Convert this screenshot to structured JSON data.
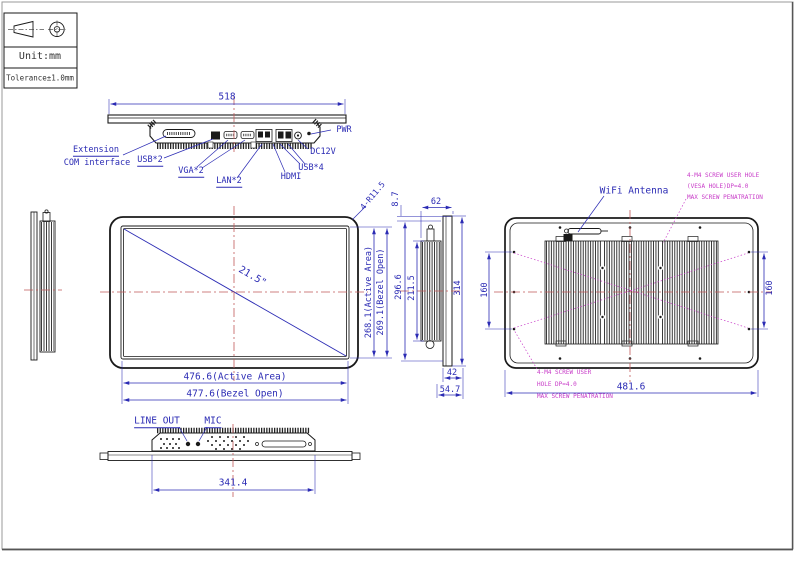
{
  "sheet": {
    "unit": "Unit:mm",
    "tolerance": "Tolerance±1.0mm",
    "projection_symbol": "first-angle-projection-icon"
  },
  "colors": {
    "outline": "#1a1a1a",
    "dimension": "#2b2bb4",
    "centerline": "#c05a5a",
    "note": "#c83cc8"
  },
  "top_view": {
    "dim_width": "518",
    "label_extension_1": "Extension",
    "label_extension_2": "COM interface",
    "label_usb2": "USB*2",
    "label_vga2": "VGA*2",
    "label_lan2": "LAN*2",
    "label_hdmi": "HDMI",
    "label_usb4": "USB*4",
    "label_dc12v": "DC12V",
    "label_pwr": "PWR"
  },
  "front_view": {
    "diagonal_size": "21.5\"",
    "corner_radius": "4-R11.5",
    "dim_height_active": "268.1(Active Area)",
    "dim_height_bezel": "269.1(Bezel Open)",
    "dim_width_active": "476.6(Active Area)",
    "dim_width_bezel": "477.6(Bezel Open)"
  },
  "side_view": {
    "dim_bezel_lip": "8.7",
    "dim_depth": "62",
    "dim_body_height": "296.6",
    "dim_heatsink_height": "211.5",
    "dim_total_height": "314",
    "dim_rear_offset": "42",
    "dim_total_depth": "54.7"
  },
  "rear_view": {
    "label_antenna": "WiFi Antenna",
    "note_top_1": "4-M4 SCREW USER HOLE",
    "note_top_2": "(VESA HOLE)DP=4.0",
    "note_top_3": "MAX SCREW PENATRATION",
    "note_bottom_1": "4-M4 SCREW USER",
    "note_bottom_2": "HOLE DP=4.0",
    "note_bottom_3": "MAX SCREW PENATRATION",
    "dim_vesa_left": "160",
    "dim_vesa_right": "160",
    "dim_width": "481.6"
  },
  "bottom_view": {
    "label_line_out": "LINE OUT",
    "label_mic": "MIC",
    "dim_width": "341.4"
  }
}
